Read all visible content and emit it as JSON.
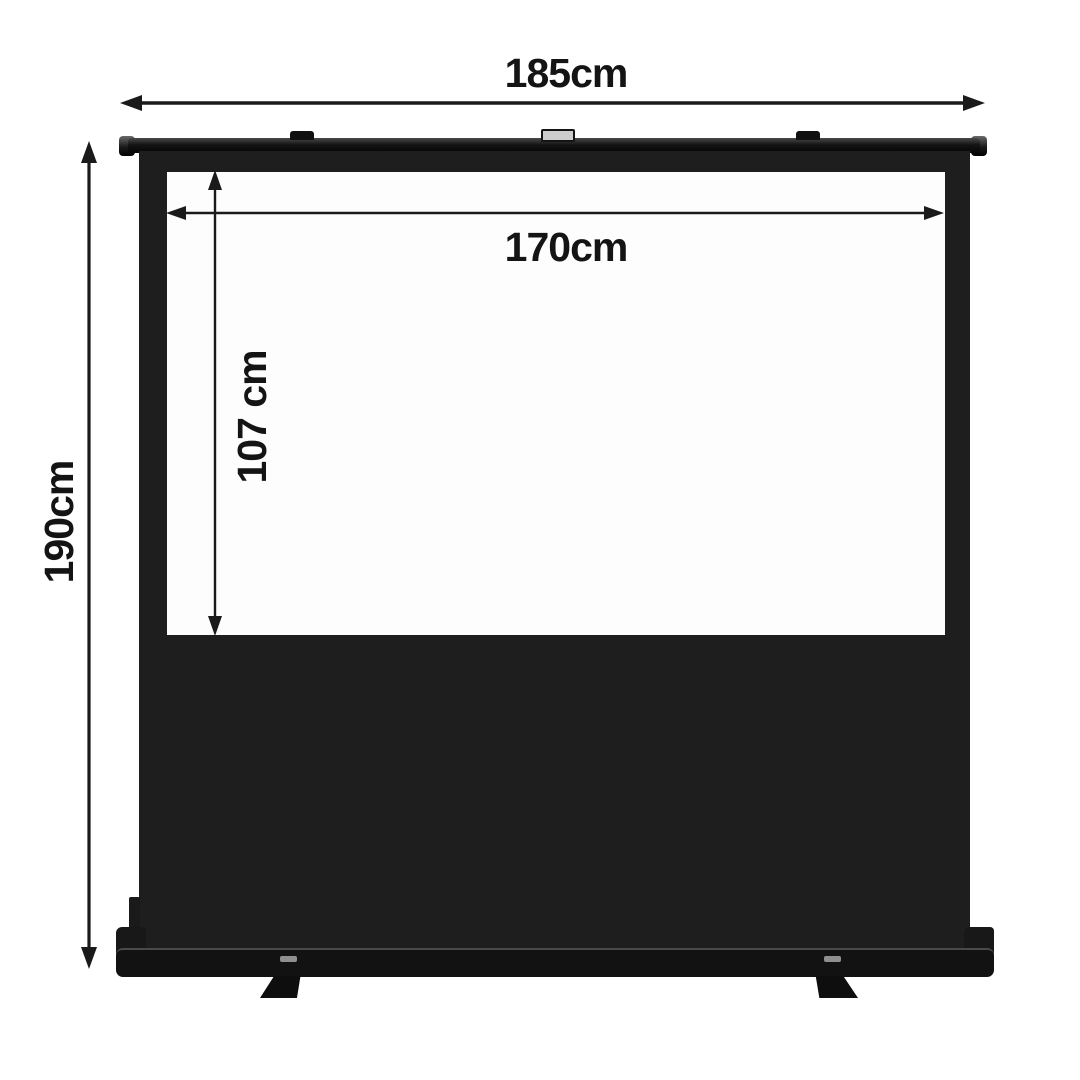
{
  "diagram": {
    "labels": {
      "total_width": "185cm",
      "total_height": "190cm",
      "viewing_width": "170cm",
      "viewing_height": "107 cm"
    },
    "colors": {
      "background": "#ffffff",
      "ink": "#141414",
      "frame_black": "#1e1e1e",
      "viewing_white": "#fdfdfd",
      "handle_gray": "#cdcdcd"
    }
  }
}
